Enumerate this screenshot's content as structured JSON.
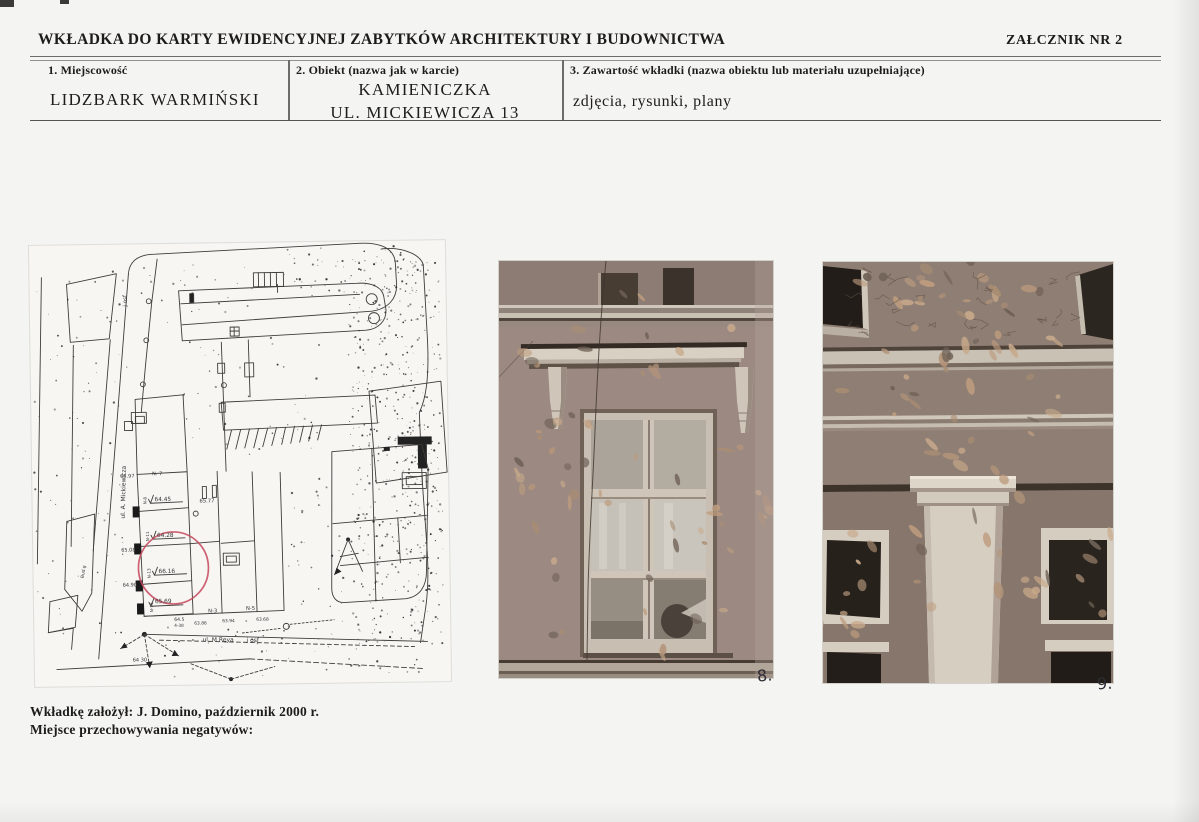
{
  "page": {
    "title": "WKŁADKA DO KARTY EWIDENCYJNEJ ZABYTKÓW ARCHITEKTURY I BUDOWNICTWA",
    "annex_label": "ZAŁCZNIK NR  2"
  },
  "record_table": {
    "field1": {
      "label": "1. Miejscowość",
      "value": "LIDZBARK WARMIŃSKI"
    },
    "field2": {
      "label": "2. Obiekt (nazwa jak w karcie)",
      "line1": "KAMIENICZKA",
      "line2": "UL. MICKIEWICZA 13"
    },
    "field3": {
      "label": "3. Zawartość wkładki (nazwa obiektu lub materiału uzupełniające)",
      "value": "zdjęcia, rysunki, plany"
    }
  },
  "site_plan": {
    "highlight_color": "#c5465a",
    "labels": [
      {
        "t": "j osf",
        "x": 97,
        "y": 62,
        "r": -90,
        "s": 5.5
      },
      {
        "t": "ul. A. Mickiewicza",
        "x": 92,
        "y": 274,
        "r": -88,
        "s": 6
      },
      {
        "t": "65.97",
        "x": 88,
        "y": 233,
        "r": 0,
        "s": 5
      },
      {
        "t": "N. 7",
        "x": 120,
        "y": 231,
        "r": 0,
        "s": 5
      },
      {
        "t": "N-8",
        "x": 114,
        "y": 260,
        "r": -90,
        "s": 4.2
      },
      {
        "t": "64.45",
        "x": 122,
        "y": 257,
        "r": 0,
        "s": 5.8
      },
      {
        "t": "65.77",
        "x": 167,
        "y": 259,
        "r": 0,
        "s": 5.2
      },
      {
        "t": "N-11",
        "x": 116,
        "y": 297,
        "r": -90,
        "s": 4.2
      },
      {
        "t": "64.28",
        "x": 124,
        "y": 293,
        "r": 0,
        "s": 5.8
      },
      {
        "t": "65.08",
        "x": 88,
        "y": 307,
        "r": 0,
        "s": 5
      },
      {
        "t": "N-13",
        "x": 117,
        "y": 334,
        "r": -90,
        "s": 4.2
      },
      {
        "t": "66.16",
        "x": 125,
        "y": 329,
        "r": 0,
        "s": 5.8
      },
      {
        "t": "64.90",
        "x": 89,
        "y": 342,
        "r": 0,
        "s": 5
      },
      {
        "t": "N-15",
        "x": 119,
        "y": 368,
        "r": -90,
        "s": 4.2
      },
      {
        "t": "65.69",
        "x": 121,
        "y": 359,
        "r": 0,
        "s": 5.8
      },
      {
        "t": "N-3",
        "x": 174,
        "y": 369,
        "r": 0,
        "s": 5.2
      },
      {
        "t": "N-5",
        "x": 212,
        "y": 367,
        "r": 0,
        "s": 5.2
      },
      {
        "t": "64.5",
        "x": 140,
        "y": 377,
        "r": 0,
        "s": 4.6
      },
      {
        "t": "4-38",
        "x": 140,
        "y": 383,
        "r": 0,
        "s": 4.2
      },
      {
        "t": "63.86",
        "x": 160,
        "y": 381,
        "r": 0,
        "s": 4.4
      },
      {
        "t": "63.94",
        "x": 188,
        "y": 379,
        "r": 0,
        "s": 4.4
      },
      {
        "t": "63.68",
        "x": 222,
        "y": 378,
        "r": 0,
        "s": 4.4
      },
      {
        "t": "ul. M Reya",
        "x": 168,
        "y": 398,
        "r": 1,
        "s": 6
      },
      {
        "t": "j osf",
        "x": 212,
        "y": 399,
        "r": 1,
        "s": 6
      },
      {
        "t": "64 30",
        "x": 98,
        "y": 417,
        "r": 0,
        "s": 5
      },
      {
        "t": "Bud.g",
        "x": 50,
        "y": 333,
        "r": -80,
        "s": 4.4
      }
    ]
  },
  "photos": [
    {
      "label": "8."
    },
    {
      "label": "9."
    }
  ],
  "footer": {
    "line1": "Wkładkę założył: J. Domino, październik 2000 r.",
    "line2": "Miejsce przechowywania negatywów:"
  }
}
